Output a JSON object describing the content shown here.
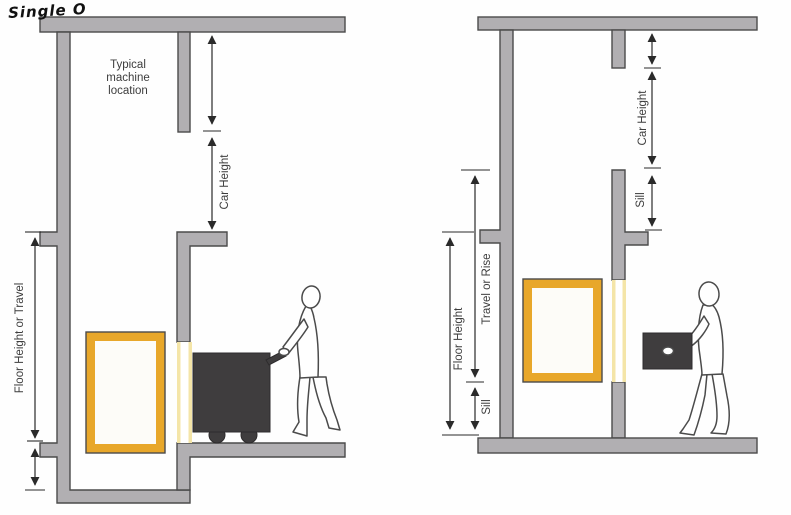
{
  "annotation": "Single O",
  "left_diagram": {
    "machine_note": {
      "line1": "Typical",
      "line2": "machine",
      "line3": "location"
    },
    "dims": {
      "car_height": "Car Height",
      "floor_height": "Floor Height or Travel"
    }
  },
  "right_diagram": {
    "dims": {
      "car_height": "Car Height",
      "sill_upper": "Sill",
      "travel": "Travel or Rise",
      "floor_height": "Floor Height",
      "sill_lower": "Sill"
    }
  },
  "colors": {
    "wall": "#b1afb2",
    "wall_outline": "#4b4b4b",
    "car_yellow": "#E8A72A",
    "gate_yellow": "#F4E5A8",
    "dark_item": "#3F3D3E",
    "line": "#2a2a2a",
    "text": "#3d3d3d"
  }
}
